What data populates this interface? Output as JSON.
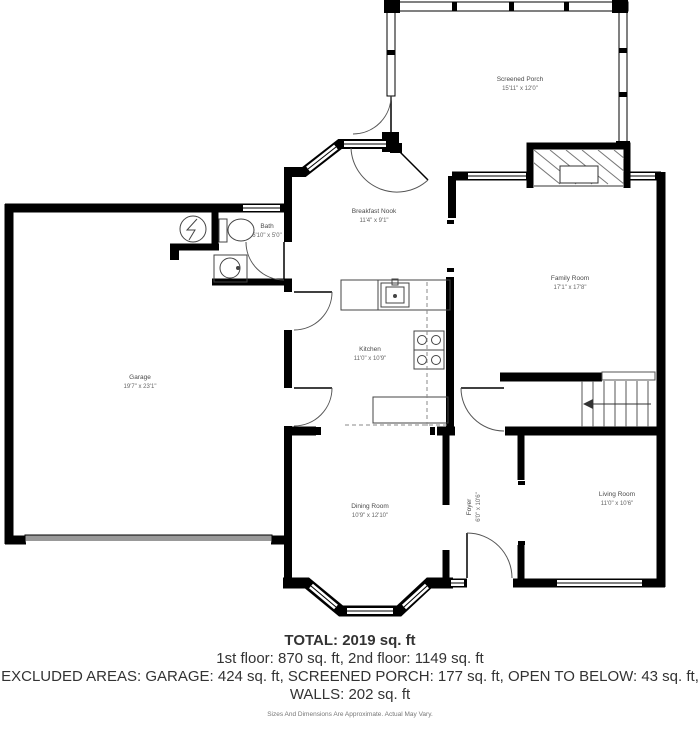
{
  "rooms": [
    {
      "name": "Screened Porch",
      "dims": "15'11\" x 12'0\""
    },
    {
      "name": "Breakfast Nook",
      "dims": "11'4\" x 9'1\""
    },
    {
      "name": "Family Room",
      "dims": "17'1\" x 17'8\""
    },
    {
      "name": "Bath",
      "dims": "6'10\" x 5'0\""
    },
    {
      "name": "Garage",
      "dims": "19'7\" x 23'1\""
    },
    {
      "name": "Kitchen",
      "dims": "11'0\" x 10'9\""
    },
    {
      "name": "Dining Room",
      "dims": "10'9\" x 12'10\""
    },
    {
      "name": "Foyer",
      "dims": "6'0\" x 10'6\""
    },
    {
      "name": "Living Room",
      "dims": "11'0\" x 10'6\""
    }
  ],
  "summary": {
    "total": "TOTAL: 2019 sq. ft",
    "floors": "1st floor: 870 sq. ft, 2nd floor: 1149 sq. ft",
    "excluded": "EXCLUDED AREAS: GARAGE: 424 sq. ft, SCREENED PORCH: 177 sq. ft, OPEN TO BELOW: 43 sq. ft,",
    "walls": "WALLS: 202 sq. ft",
    "disclaimer": "Sizes And Dimensions Are Approximate. Actual May Vary."
  },
  "colors": {
    "wall": "#000000",
    "thin_line": "#444444",
    "garage_door": "#999999",
    "label": "#4a4a4a"
  }
}
